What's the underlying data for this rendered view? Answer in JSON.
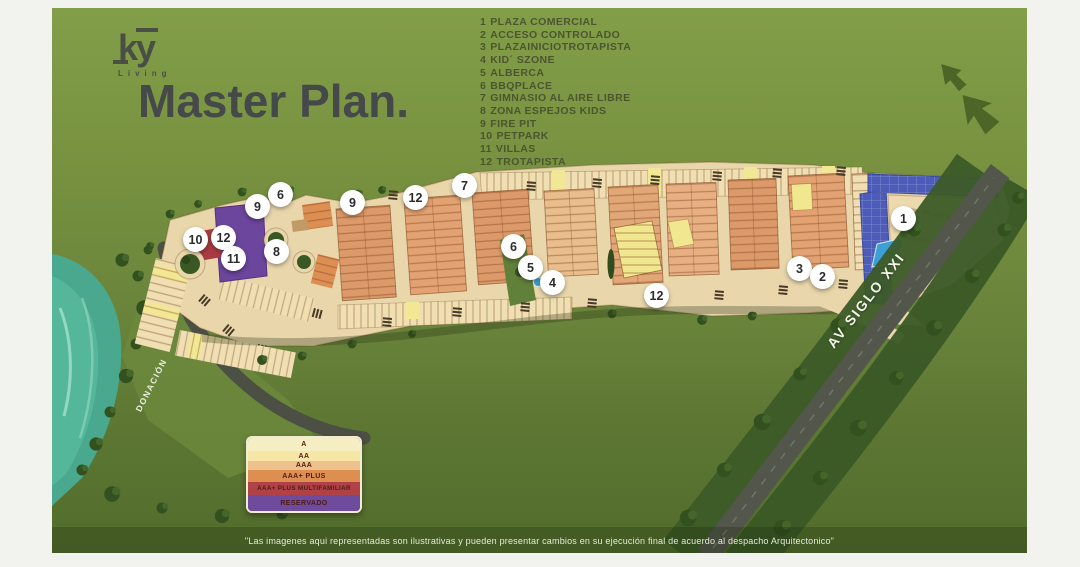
{
  "logo": {
    "mark": "ky",
    "sub": "Living"
  },
  "title": "Master Plan.",
  "amenities": [
    {
      "num": "1",
      "label": "PLAZA COMERCIAL"
    },
    {
      "num": "2",
      "label": "ACCESO CONTROLADO"
    },
    {
      "num": "3",
      "label": "PLAZAINICIOTROTAPISTA"
    },
    {
      "num": "4",
      "label": "KID´ SZONE"
    },
    {
      "num": "5",
      "label": "ALBERCA"
    },
    {
      "num": "6",
      "label": "BBQPLACE"
    },
    {
      "num": "7",
      "label": "GIMNASIO AL AIRE LIBRE"
    },
    {
      "num": "8",
      "label": "ZONA ESPEJOS KIDS"
    },
    {
      "num": "9",
      "label": "FIRE PIT"
    },
    {
      "num": "10",
      "label": "PETPARK"
    },
    {
      "num": "11",
      "label": "VILLAS"
    },
    {
      "num": "12",
      "label": "TROTAPISTA"
    }
  ],
  "markers": [
    "6",
    "9",
    "10",
    "12",
    "11",
    "8",
    "9",
    "12",
    "7",
    "6",
    "5",
    "4",
    "12",
    "3",
    "2",
    "1"
  ],
  "map_labels": {
    "road": "AV SIGLO XXI",
    "donation": "DONACIÓN"
  },
  "legend": {
    "items": [
      {
        "label": "A",
        "color": "#f6eec3"
      },
      {
        "label": "AA",
        "color": "#f7e7a6"
      },
      {
        "label": "AAA",
        "color": "#eec08b"
      },
      {
        "label": "AAA+ PLUS",
        "color": "#dd8f52"
      },
      {
        "label": "AAA+ PLUS MULTIFAMILIAR",
        "color": "#b04147"
      },
      {
        "label": "RESERVADO",
        "color": "#6f4b9e"
      }
    ]
  },
  "footer": "\"Las imagenes aqui representadas son ilustrativas y pueden presentar cambios en su ejecución final de acuerdo al despacho Arquitectonico\"",
  "colors": {
    "canvas_frame": "#f2f2ef",
    "map_green": "#76903f",
    "title_text": "#45494a",
    "list_text": "#48502f",
    "water_teal": "#49a88e",
    "dark_road": "#52564b",
    "platform_beige": "#e9d6ab",
    "panels_blue": "#4c5cb8",
    "pool_blue": "#3aa0d6",
    "purple_reserved": "#6b469c",
    "red_multifam": "#a83b42",
    "marker_bg": "#ffffff",
    "marker_text": "#2c2c2c"
  }
}
